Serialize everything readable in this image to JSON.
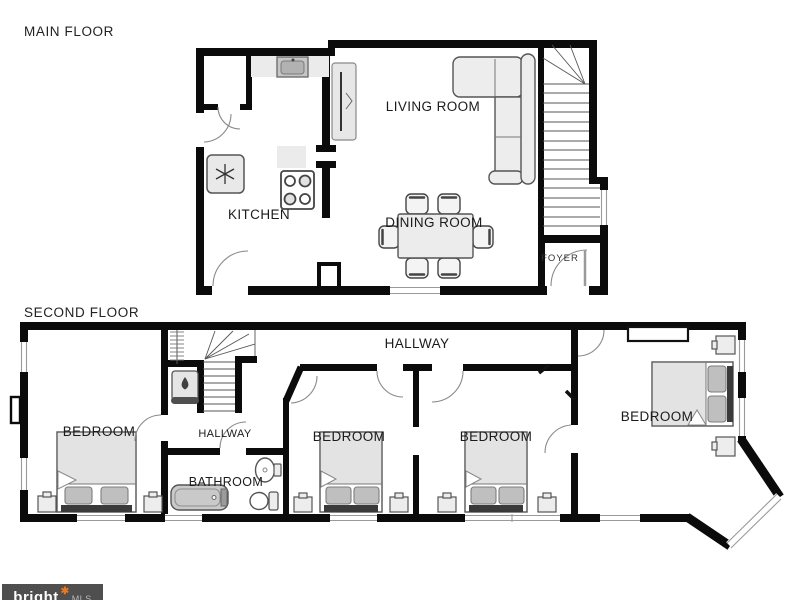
{
  "titles": {
    "main_floor": "MAIN FLOOR",
    "second_floor": "SECOND FLOOR"
  },
  "main_floor": {
    "rooms": {
      "living_room": "LIVING ROOM",
      "dining_room": "DINING ROOM",
      "kitchen": "KITCHEN",
      "foyer": "FOYER"
    }
  },
  "second_floor": {
    "rooms": {
      "hallway": "HALLWAY",
      "bedroom_left": "BEDROOM",
      "hallway_small": "HALLWAY",
      "bathroom": "BATHROOM",
      "bedroom_mid_left": "BEDROOM",
      "bedroom_mid_right": "BEDROOM",
      "bedroom_right": "BEDROOM"
    }
  },
  "watermark": {
    "brand": "bright",
    "star": "✱",
    "suffix": "MLS"
  },
  "colors": {
    "wall": "#0b0b0b",
    "accent_star": "#e8791f",
    "watermark_bg": "#4f4f4f",
    "label": "#1b1b1b"
  }
}
